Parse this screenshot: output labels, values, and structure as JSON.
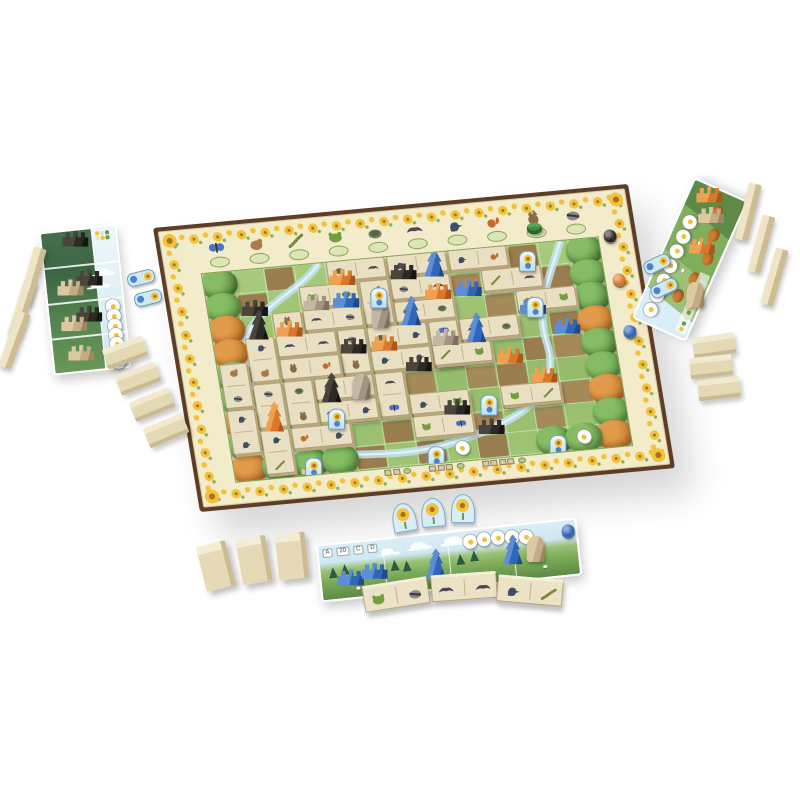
{
  "scene": {
    "background": "#ffffff",
    "description": "Top-angled photo of a nature board game in play: central valley board with sunflower score track border, animal dominoes and wooden plant pieces, three player boards, face-down domino blocks, bonus cards and flower tokens"
  },
  "palette": {
    "frame_brown": "#5c3d28",
    "board_cream": "#f3ecca",
    "sunflower_yellow": "#f1c23a",
    "meadow_green": "#93bb69",
    "dirt_brown": "#9f8354",
    "stream_blue": "#bfe2ee",
    "player_orange": "#d9782a",
    "player_blue": "#2f66b5",
    "player_black": "#2c2925",
    "stone_gray": "#a3947f",
    "wood_tan": "#e5d9b4"
  },
  "main_board": {
    "grid": {
      "cols": 13,
      "rows": 9
    },
    "track_animals": [
      {
        "name": "butterfly",
        "color": "#4a72c8"
      },
      {
        "name": "hamster",
        "color": "#a97b48"
      },
      {
        "name": "lizard",
        "color": "#7a8a3a"
      },
      {
        "name": "frog",
        "color": "#6fa03c"
      },
      {
        "name": "turtle",
        "color": "#6e7f5a"
      },
      {
        "name": "bat",
        "color": "#4a4a55"
      },
      {
        "name": "woodpecker",
        "color": "#3d4f66"
      },
      {
        "name": "squirrel",
        "color": "#c56a2b"
      },
      {
        "name": "owl",
        "color": "#8a6a44"
      },
      {
        "name": "raccoon",
        "color": "#8b8b90"
      }
    ],
    "owl_cylinder_color": "#3f8f3f",
    "scoring_discs": [
      {
        "color": "#2c2925",
        "label": "black-scoring-disc",
        "x": 453,
        "y": 50
      },
      {
        "color": "#d9782a",
        "label": "orange-scoring-disc",
        "x": 455,
        "y": 95
      },
      {
        "color": "#2f66b5",
        "label": "blue-scoring-disc",
        "x": 457,
        "y": 148
      }
    ],
    "dirt_cells": [
      [
        2,
        0
      ],
      [
        5,
        0
      ],
      [
        6,
        0
      ],
      [
        9,
        0
      ],
      [
        10,
        0
      ],
      [
        1,
        1
      ],
      [
        4,
        1
      ],
      [
        5,
        1
      ],
      [
        6,
        1
      ],
      [
        8,
        1
      ],
      [
        9,
        1
      ],
      [
        10,
        1
      ],
      [
        11,
        1
      ],
      [
        2,
        2
      ],
      [
        3,
        2
      ],
      [
        5,
        2
      ],
      [
        6,
        2
      ],
      [
        7,
        2
      ],
      [
        9,
        2
      ],
      [
        10,
        2
      ],
      [
        1,
        3
      ],
      [
        3,
        3
      ],
      [
        4,
        3
      ],
      [
        6,
        3
      ],
      [
        8,
        3
      ],
      [
        9,
        3
      ],
      [
        11,
        3
      ],
      [
        2,
        4
      ],
      [
        4,
        4
      ],
      [
        5,
        4
      ],
      [
        7,
        4
      ],
      [
        8,
        4
      ],
      [
        10,
        4
      ],
      [
        11,
        4
      ],
      [
        1,
        5
      ],
      [
        3,
        5
      ],
      [
        5,
        5
      ],
      [
        6,
        5
      ],
      [
        8,
        5
      ],
      [
        9,
        5
      ],
      [
        2,
        6
      ],
      [
        4,
        6
      ],
      [
        6,
        6
      ],
      [
        7,
        6
      ],
      [
        9,
        6
      ],
      [
        10,
        6
      ],
      [
        11,
        6
      ],
      [
        3,
        7
      ],
      [
        5,
        7
      ],
      [
        7,
        7
      ],
      [
        8,
        7
      ],
      [
        10,
        7
      ],
      [
        4,
        8
      ],
      [
        6,
        8
      ],
      [
        8,
        8
      ]
    ],
    "trees": [
      {
        "c": 0,
        "r": 0,
        "tone": "green"
      },
      {
        "c": 0,
        "r": 1,
        "tone": "green"
      },
      {
        "c": 0,
        "r": 2,
        "tone": "orange"
      },
      {
        "c": 0,
        "r": 3,
        "tone": "orange"
      },
      {
        "c": 0,
        "r": 4,
        "tone": "green"
      },
      {
        "c": 0,
        "r": 5,
        "tone": "green"
      },
      {
        "c": 0,
        "r": 6,
        "tone": "orange"
      },
      {
        "c": 0,
        "r": 7,
        "tone": "green"
      },
      {
        "c": 0,
        "r": 8,
        "tone": "orange"
      },
      {
        "c": 12,
        "r": 0,
        "tone": "green"
      },
      {
        "c": 12,
        "r": 1,
        "tone": "green"
      },
      {
        "c": 12,
        "r": 2,
        "tone": "green"
      },
      {
        "c": 12,
        "r": 3,
        "tone": "orange"
      },
      {
        "c": 12,
        "r": 4,
        "tone": "green"
      },
      {
        "c": 12,
        "r": 5,
        "tone": "green"
      },
      {
        "c": 12,
        "r": 6,
        "tone": "orange"
      },
      {
        "c": 12,
        "r": 7,
        "tone": "green"
      },
      {
        "c": 12,
        "r": 8,
        "tone": "orange"
      },
      {
        "c": 1,
        "r": 8,
        "tone": "green"
      },
      {
        "c": 2,
        "r": 8,
        "tone": "green"
      },
      {
        "c": 3,
        "r": 8,
        "tone": "green"
      },
      {
        "c": 10,
        "r": 8,
        "tone": "green"
      },
      {
        "c": 11,
        "r": 8,
        "tone": "green"
      }
    ],
    "dominoes": [
      {
        "c": 4,
        "r": 0,
        "d": "h",
        "a": [
          "turtle",
          "bat"
        ]
      },
      {
        "c": 6,
        "r": 0,
        "d": "h",
        "a": [
          "woodpecker",
          "owl"
        ]
      },
      {
        "c": 8,
        "r": 0,
        "d": "h",
        "a": [
          "woodpecker",
          "squirrel"
        ]
      },
      {
        "c": 3,
        "r": 1,
        "d": "h",
        "a": [
          "frog",
          "turtle"
        ]
      },
      {
        "c": 5,
        "r": 1,
        "d": "v",
        "a": [
          "lizard",
          "frog"
        ]
      },
      {
        "c": 6,
        "r": 1,
        "d": "h",
        "a": [
          "raccoon",
          "bat"
        ]
      },
      {
        "c": 9,
        "r": 1,
        "d": "h",
        "a": [
          "lizard",
          "bat"
        ]
      },
      {
        "c": 2,
        "r": 2,
        "d": "v",
        "a": [
          "owl",
          "turtle"
        ]
      },
      {
        "c": 3,
        "r": 2,
        "d": "h",
        "a": [
          "bat",
          "raccoon"
        ]
      },
      {
        "c": 6,
        "r": 2,
        "d": "h",
        "a": [
          "turtle",
          "turtle"
        ]
      },
      {
        "c": 10,
        "r": 2,
        "d": "h",
        "a": [
          "squirrel",
          "frog"
        ]
      },
      {
        "c": 1,
        "r": 3,
        "d": "v",
        "a": [
          "woodpecker",
          "hamster"
        ]
      },
      {
        "c": 2,
        "r": 3,
        "d": "h",
        "a": [
          "bat",
          "bat"
        ]
      },
      {
        "c": 4,
        "r": 3,
        "d": "v",
        "a": [
          "raccoon",
          "owl"
        ]
      },
      {
        "c": 5,
        "r": 3,
        "d": "h",
        "a": [
          "turtle",
          "woodpecker"
        ]
      },
      {
        "c": 7,
        "r": 3,
        "d": "v",
        "a": [
          "butterfly",
          "lizard"
        ]
      },
      {
        "c": 8,
        "r": 3,
        "d": "h",
        "a": [
          "bat",
          "turtle"
        ]
      },
      {
        "c": 0,
        "r": 4,
        "d": "v",
        "a": [
          "hamster",
          "raccoon"
        ]
      },
      {
        "c": 2,
        "r": 4,
        "d": "h",
        "a": [
          "owl",
          "squirrel"
        ]
      },
      {
        "c": 5,
        "r": 4,
        "d": "h",
        "a": [
          "woodpecker",
          "woodpecker"
        ]
      },
      {
        "c": 7,
        "r": 4,
        "d": "h",
        "a": [
          "lizard",
          "frog"
        ]
      },
      {
        "c": 1,
        "r": 5,
        "d": "v",
        "a": [
          "raccoon",
          "woodpecker"
        ]
      },
      {
        "c": 2,
        "r": 5,
        "d": "v",
        "a": [
          "turtle",
          "owl"
        ]
      },
      {
        "c": 3,
        "r": 5,
        "d": "h",
        "a": [
          "owl",
          "bat"
        ]
      },
      {
        "c": 5,
        "r": 5,
        "d": "v",
        "a": [
          "bat",
          "butterfly"
        ]
      },
      {
        "c": 0,
        "r": 6,
        "d": "v",
        "a": [
          "woodpecker",
          "woodpecker"
        ]
      },
      {
        "c": 3,
        "r": 6,
        "d": "h",
        "a": [
          "bat",
          "woodpecker"
        ]
      },
      {
        "c": 6,
        "r": 6,
        "d": "h",
        "a": [
          "woodpecker",
          "frog"
        ]
      },
      {
        "c": 9,
        "r": 6,
        "d": "h",
        "a": [
          "frog",
          "lizard"
        ]
      },
      {
        "c": 1,
        "r": 7,
        "d": "v",
        "a": [
          "woodpecker",
          "lizard"
        ]
      },
      {
        "c": 2,
        "r": 7,
        "d": "h",
        "a": [
          "squirrel",
          "woodpecker"
        ]
      },
      {
        "c": 6,
        "r": 7,
        "d": "h",
        "a": [
          "frog",
          "butterfly"
        ]
      }
    ],
    "plants": [
      {
        "c": 4,
        "r": 0,
        "color": "orange",
        "shape": "comb"
      },
      {
        "c": 6,
        "r": 0,
        "color": "black",
        "shape": "comb"
      },
      {
        "c": 7,
        "r": 0,
        "color": "blue",
        "shape": "tree"
      },
      {
        "c": 1,
        "r": 1,
        "color": "black",
        "shape": "comb"
      },
      {
        "c": 3,
        "r": 1,
        "color": "gray",
        "shape": "comb"
      },
      {
        "c": 4,
        "r": 1,
        "color": "blue",
        "shape": "comb"
      },
      {
        "c": 7,
        "r": 1,
        "color": "orange",
        "shape": "comb"
      },
      {
        "c": 8,
        "r": 1,
        "color": "blue",
        "shape": "comb"
      },
      {
        "c": 1,
        "r": 2,
        "color": "black",
        "shape": "tree"
      },
      {
        "c": 2,
        "r": 2,
        "color": "orange",
        "shape": "comb"
      },
      {
        "c": 5,
        "r": 2,
        "color": "gray",
        "shape": "menhir"
      },
      {
        "c": 6,
        "r": 2,
        "color": "blue",
        "shape": "tree"
      },
      {
        "c": 10,
        "r": 2,
        "color": "blue",
        "shape": "comb"
      },
      {
        "c": 4,
        "r": 3,
        "color": "black",
        "shape": "comb"
      },
      {
        "c": 5,
        "r": 3,
        "color": "orange",
        "shape": "comb"
      },
      {
        "c": 7,
        "r": 3,
        "color": "gray",
        "shape": "comb"
      },
      {
        "c": 8,
        "r": 3,
        "color": "blue",
        "shape": "tree"
      },
      {
        "c": 11,
        "r": 3,
        "color": "blue",
        "shape": "comb"
      },
      {
        "c": 6,
        "r": 4,
        "color": "black",
        "shape": "comb"
      },
      {
        "c": 9,
        "r": 4,
        "color": "orange",
        "shape": "comb"
      },
      {
        "c": 3,
        "r": 5,
        "color": "black",
        "shape": "tree"
      },
      {
        "c": 4,
        "r": 5,
        "color": "gray",
        "shape": "menhir"
      },
      {
        "c": 10,
        "r": 5,
        "color": "orange",
        "shape": "comb"
      },
      {
        "c": 1,
        "r": 6,
        "color": "orange",
        "shape": "tree"
      },
      {
        "c": 7,
        "r": 6,
        "color": "black",
        "shape": "comb"
      },
      {
        "c": 2,
        "r": 8,
        "color": "tan",
        "shape": "stairs"
      },
      {
        "c": 8,
        "r": 7,
        "color": "black",
        "shape": "comb"
      }
    ],
    "bonus_cards": [
      [
        5,
        1
      ],
      [
        10,
        0
      ],
      [
        10,
        2
      ],
      [
        3,
        6
      ],
      [
        8,
        6
      ],
      [
        2,
        8
      ],
      [
        6,
        8
      ],
      [
        10,
        8
      ]
    ],
    "flower_tokens": [
      [
        7,
        8
      ],
      [
        11,
        8
      ]
    ],
    "bottom_scoring_groups": [
      2,
      3,
      4
    ]
  },
  "left_player_board": {
    "player_color": "black",
    "pieces": [
      {
        "shape": "comb",
        "color": "black",
        "x": 20,
        "y": 0
      },
      {
        "shape": "comb",
        "color": "black",
        "x": 30,
        "y": 40
      },
      {
        "shape": "comb",
        "color": "tan",
        "x": 10,
        "y": 48
      },
      {
        "shape": "comb",
        "color": "black",
        "x": 26,
        "y": 76
      },
      {
        "shape": "comb",
        "color": "tan",
        "x": 10,
        "y": 84
      },
      {
        "shape": "comb",
        "color": "tan",
        "x": 14,
        "y": 114
      }
    ],
    "clouds": [
      {
        "x": 50,
        "y": 40
      },
      {
        "x": 44,
        "y": 52
      }
    ],
    "flowers": [
      {
        "x": 57,
        "y": 72
      },
      {
        "x": 57,
        "y": 82
      },
      {
        "x": 57,
        "y": 92
      },
      {
        "x": 57,
        "y": 101
      },
      {
        "x": 57,
        "y": 110
      },
      {
        "x": 57,
        "y": 119
      },
      {
        "x": 57,
        "y": 128
      },
      {
        "x": 57,
        "y": 124
      }
    ]
  },
  "right_player_board": {
    "player_color": "orange",
    "flowers": [
      {
        "x": 6,
        "y": 5
      },
      {
        "x": 22,
        "y": 5
      },
      {
        "x": 38,
        "y": 5
      },
      {
        "x": 54,
        "y": 5
      },
      {
        "x": 70,
        "y": 5
      },
      {
        "x": 86,
        "y": 5
      },
      {
        "x": 102,
        "y": 5
      }
    ],
    "pieces": [
      {
        "shape": "comb",
        "color": "orange",
        "x": 122,
        "y": 6
      },
      {
        "shape": "comb",
        "color": "tan",
        "x": 104,
        "y": 16
      },
      {
        "shape": "comb",
        "color": "orange",
        "x": 72,
        "y": 20
      },
      {
        "shape": "menhir",
        "color": "tan",
        "x": 24,
        "y": 26
      }
    ]
  },
  "bottom_player_board": {
    "player_color": "blue",
    "labels": [
      "A",
      "20",
      "C",
      "D"
    ],
    "flowers": [
      {
        "x": 145,
        "y": 4
      },
      {
        "x": 159,
        "y": 3
      },
      {
        "x": 173,
        "y": 3
      },
      {
        "x": 187,
        "y": 4
      },
      {
        "x": 201,
        "y": 5
      }
    ],
    "pieces": [
      {
        "shape": "comb",
        "color": "blue",
        "x": 16,
        "y": 26
      },
      {
        "shape": "comb",
        "color": "blue",
        "x": 40,
        "y": 22
      },
      {
        "shape": "tree",
        "color": "blue",
        "x": 104,
        "y": 14
      },
      {
        "shape": "tree",
        "color": "blue",
        "x": 182,
        "y": 8
      },
      {
        "shape": "menhir",
        "color": "tan",
        "x": 206,
        "y": 12
      },
      {
        "shape": "disc",
        "color": "blue",
        "x": 244,
        "y": 4
      }
    ]
  },
  "bonus_tokens": [
    {
      "x": 140,
      "y": 277,
      "rot": -14
    },
    {
      "x": 147,
      "y": 297,
      "rot": -14
    },
    {
      "x": 656,
      "y": 263,
      "rot": -25
    },
    {
      "x": 663,
      "y": 287,
      "rot": -25
    }
  ],
  "sunflower_tokens": [
    {
      "x": 403,
      "y": 516,
      "rot": -10
    },
    {
      "x": 432,
      "y": 511,
      "rot": -5
    },
    {
      "x": 462,
      "y": 507,
      "rot": 0
    }
  ],
  "open_dominoes": [
    {
      "x": 395,
      "y": 593,
      "rot": -9,
      "a": [
        "frog",
        "raccoon"
      ]
    },
    {
      "x": 463,
      "y": 585,
      "rot": -4,
      "a": [
        "bat",
        "bat"
      ]
    },
    {
      "x": 529,
      "y": 589,
      "rot": 5,
      "a": [
        "woodpecker",
        "lizard"
      ]
    }
  ],
  "facedown_blocks": {
    "left_standing": [
      {
        "x": 32,
        "y": 276,
        "rot": 16
      },
      {
        "x": 22,
        "y": 308,
        "rot": 18
      },
      {
        "x": 14,
        "y": 340,
        "rot": 20
      }
    ],
    "left_flat": [
      {
        "x": 125,
        "y": 352,
        "rot": -20
      },
      {
        "x": 138,
        "y": 378,
        "rot": -21
      },
      {
        "x": 152,
        "y": 404,
        "rot": -22
      },
      {
        "x": 166,
        "y": 430,
        "rot": -23
      }
    ],
    "right_standing": [
      {
        "x": 748,
        "y": 212,
        "rot": 14
      },
      {
        "x": 761,
        "y": 244,
        "rot": 15
      },
      {
        "x": 774,
        "y": 277,
        "rot": 16
      }
    ],
    "right_flat": [
      {
        "x": 714,
        "y": 345,
        "rot": -8
      },
      {
        "x": 711,
        "y": 366,
        "rot": -6
      },
      {
        "x": 719,
        "y": 388,
        "rot": -7
      }
    ],
    "bottom_upright": [
      {
        "x": 216,
        "y": 566,
        "rot": -14
      },
      {
        "x": 254,
        "y": 560,
        "rot": -10
      },
      {
        "x": 292,
        "y": 556,
        "rot": -6
      }
    ]
  }
}
